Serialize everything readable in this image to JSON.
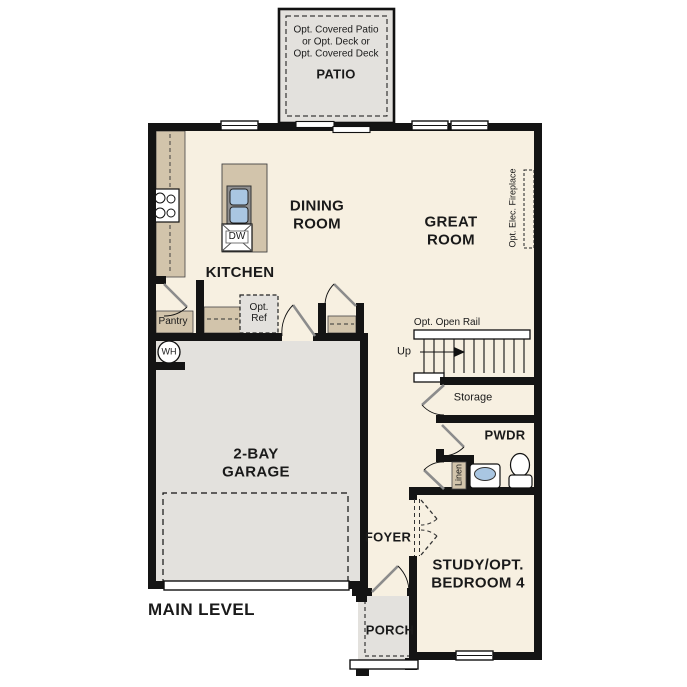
{
  "colors": {
    "wall": "#141414",
    "floor": "#f7f0e1",
    "counter": "#d2c4ab",
    "concrete": "#e3e1dd",
    "fixture": "#a9c6e2",
    "leaf": "#8c8c8c",
    "ink": "#1a1a1a"
  },
  "title": "MAIN LEVEL",
  "patio": {
    "note": [
      "Opt. Covered Patio",
      "or Opt. Deck or",
      "Opt. Covered Deck"
    ],
    "label": "PATIO"
  },
  "rooms": {
    "dining": [
      "DINING",
      "ROOM"
    ],
    "great": [
      "GREAT",
      "ROOM"
    ],
    "kitchen": "KITCHEN",
    "garage": [
      "2-BAY",
      "GARAGE"
    ],
    "study": [
      "STUDY/OPT.",
      "BEDROOM 4"
    ],
    "foyer": "FOYER",
    "porch": "PORCH",
    "pwdr": "PWDR",
    "storage": "Storage",
    "pantry": "Pantry",
    "linen": "Linen"
  },
  "annotations": {
    "open_rail": "Opt. Open Rail",
    "up": "Up",
    "ref": [
      "Opt.",
      "Ref"
    ],
    "fireplace": "Opt. Elec. Fireplace",
    "water_heater": "WH",
    "dishwasher": "DW"
  }
}
